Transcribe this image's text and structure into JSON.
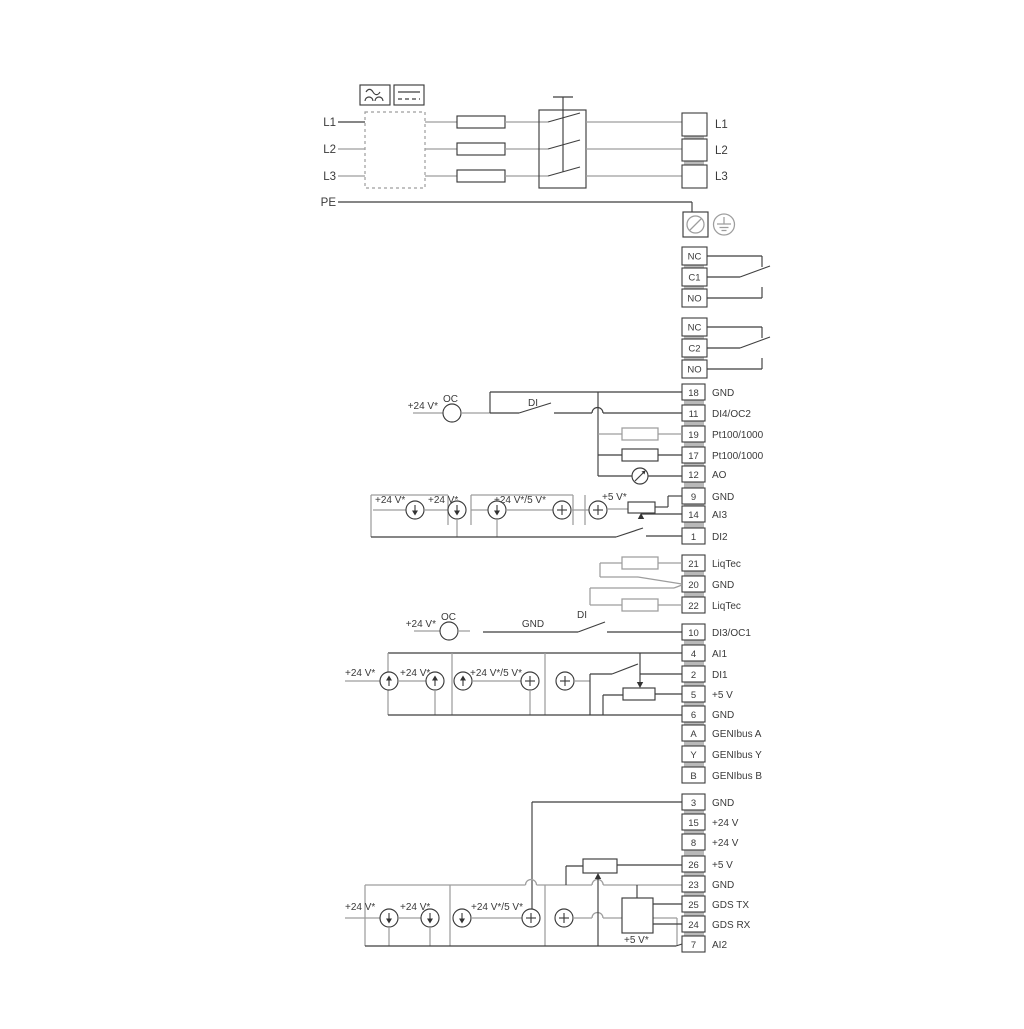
{
  "colors": {
    "wire_dark": "#3f3f3f",
    "wire_gray": "#9d9d9d",
    "text": "#3a3a3a",
    "background": "#ffffff"
  },
  "mains": {
    "inputs": [
      "L1",
      "L2",
      "L3",
      "PE"
    ],
    "outputs": [
      "L1",
      "L2",
      "L3"
    ]
  },
  "relay1": {
    "rows": [
      "NC",
      "C1",
      "NO"
    ]
  },
  "relay2": {
    "rows": [
      "NC",
      "C2",
      "NO"
    ]
  },
  "io_top": {
    "rows": [
      {
        "num": "18",
        "label": "GND"
      },
      {
        "num": "11",
        "label": "DI4/OC2"
      },
      {
        "num": "19",
        "label": "Pt100/1000"
      },
      {
        "num": "17",
        "label": "Pt100/1000"
      },
      {
        "num": "12",
        "label": "AO"
      },
      {
        "num": "9",
        "label": "GND"
      },
      {
        "num": "14",
        "label": "AI3"
      },
      {
        "num": "1",
        "label": "DI2"
      }
    ]
  },
  "liqtec": {
    "rows": [
      {
        "num": "21",
        "label": "LiqTec"
      },
      {
        "num": "20",
        "label": "GND"
      },
      {
        "num": "22",
        "label": "LiqTec"
      }
    ]
  },
  "io_mid": {
    "rows": [
      {
        "num": "10",
        "label": "DI3/OC1"
      },
      {
        "num": "4",
        "label": "AI1"
      },
      {
        "num": "2",
        "label": "DI1"
      },
      {
        "num": "5",
        "label": "+5 V"
      },
      {
        "num": "6",
        "label": "GND"
      },
      {
        "num": "A",
        "label": "GENIbus A"
      },
      {
        "num": "Y",
        "label": "GENIbus Y"
      },
      {
        "num": "B",
        "label": "GENIbus B"
      }
    ]
  },
  "io_bottom": {
    "rows": [
      {
        "num": "3",
        "label": "GND"
      },
      {
        "num": "15",
        "label": "+24 V"
      },
      {
        "num": "8",
        "label": "+24 V"
      },
      {
        "num": "26",
        "label": "+5 V"
      },
      {
        "num": "23",
        "label": "GND"
      },
      {
        "num": "25",
        "label": "GDS TX"
      },
      {
        "num": "24",
        "label": "GDS RX"
      },
      {
        "num": "7",
        "label": "AI2"
      }
    ]
  },
  "annotations": {
    "oc": "OC",
    "di": "DI",
    "gnd": "GND",
    "v24": "+24 V*",
    "v24_5": "+24 V*/5 V*",
    "v5": "+5 V*"
  }
}
